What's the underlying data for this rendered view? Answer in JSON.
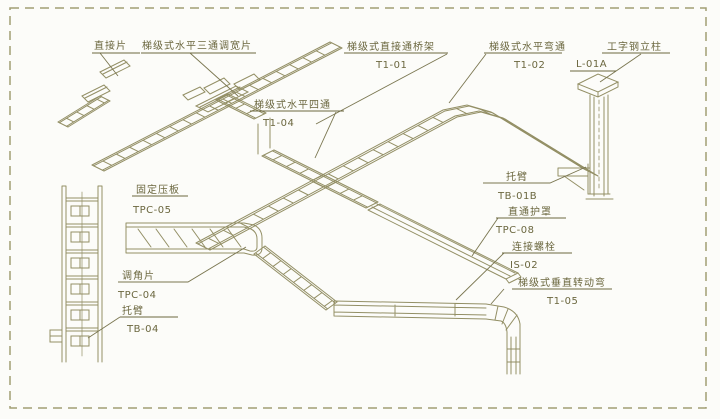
{
  "diagram_type": "ladder-cable-tray-installation-diagram",
  "colors": {
    "line": "#938f65",
    "text": "#6b673f",
    "leader": "#7a7650",
    "border_dash": "#a29e74",
    "background": "#fcfcf9"
  },
  "labels": {
    "connector_plate": {
      "name": "直接片",
      "code": ""
    },
    "tee_width_adjuster": {
      "name": "梯级式水平三通调宽片",
      "code": ""
    },
    "straight_bridge": {
      "name": "梯级式直接通桥架",
      "code": "T1-01"
    },
    "horizontal_bend": {
      "name": "梯级式水平弯通",
      "code": "T1-02"
    },
    "i_beam_column": {
      "name": "工字钢立柱",
      "code": "L-01A"
    },
    "horizontal_cross": {
      "name": "梯级式水平四通",
      "code": "T1-04"
    },
    "bracket_arm_right": {
      "name": "托臂",
      "code": "TB-01B"
    },
    "straight_cover": {
      "name": "直通护罩",
      "code": "TPC-08"
    },
    "connecting_bolt": {
      "name": "连接螺栓",
      "code": "IS-02"
    },
    "vertical_rotating_bend": {
      "name": "梯级式垂直转动弯",
      "code": "T1-05"
    },
    "fixing_plate": {
      "name": "固定压板",
      "code": "TPC-05"
    },
    "angle_adjuster": {
      "name": "调角片",
      "code": "TPC-04"
    },
    "bracket_arm_left": {
      "name": "托臂",
      "code": "TB-04"
    }
  }
}
